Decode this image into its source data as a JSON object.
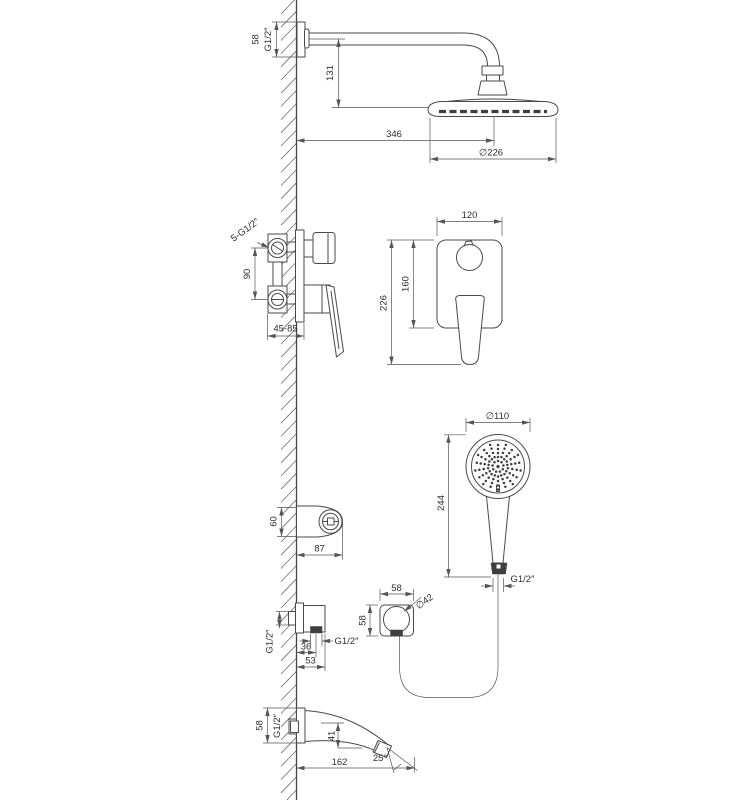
{
  "drawing": {
    "overhead_shower": {
      "plate_size": "58",
      "thread": "G1/2″",
      "arm_drop": "131",
      "arm_reach": "346",
      "head_diameter": "∅226"
    },
    "mixer_side": {
      "connections_thread": "5-G1/2″",
      "port_spacing": "90",
      "install_depth": "45-85"
    },
    "mixer_front": {
      "plate_width": "120",
      "plate_height": "160",
      "total_height": "226"
    },
    "hand_shower": {
      "head_diameter": "∅110",
      "length": "244",
      "thread": "G1/2″"
    },
    "holder": {
      "height": "60",
      "reach": "87"
    },
    "outlet_elbow_side": {
      "inlet_thread": "G1/2″",
      "outlet_thread": "G1/2″",
      "outlet_offset": "36",
      "depth": "53"
    },
    "outlet_elbow_front": {
      "width": "58",
      "height": "58",
      "hole_diameter": "∅42"
    },
    "spout": {
      "plate_size": "58",
      "thread": "G1/2″",
      "drop": "41",
      "reach": "162",
      "angle": "25°"
    }
  }
}
